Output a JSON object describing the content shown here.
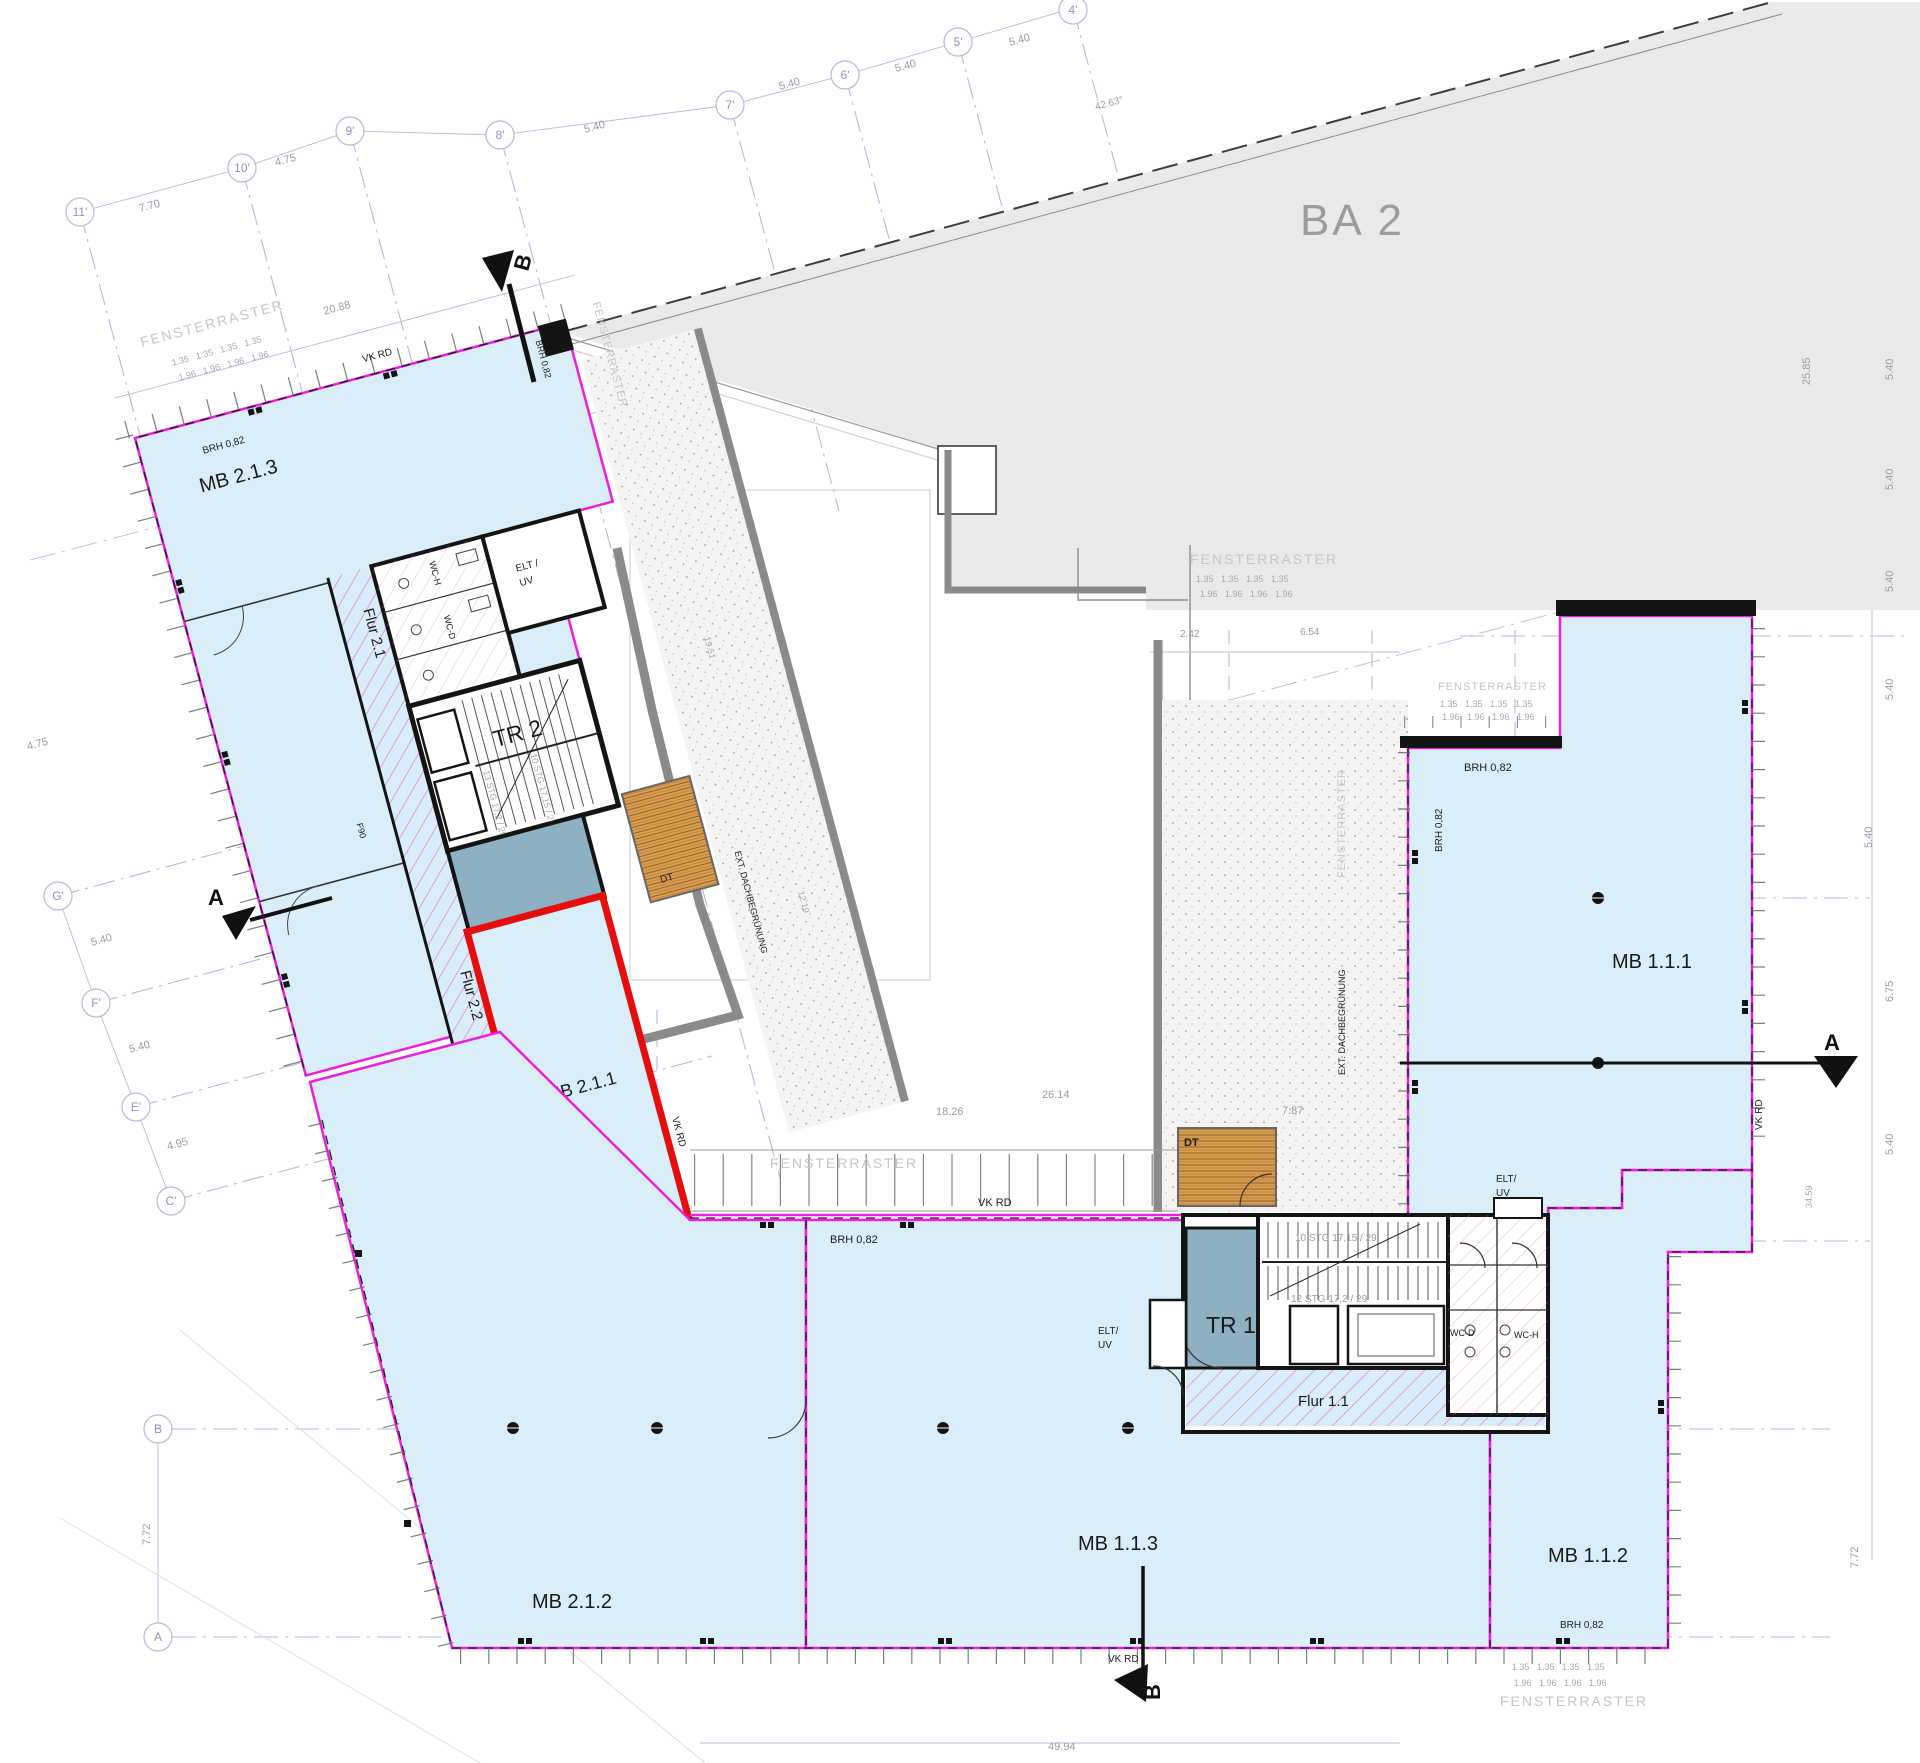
{
  "title": "Floor plan",
  "rooms": {
    "mb213": "MB 2.1.3",
    "mb211": "MB 2.1.1",
    "mb212": "MB 2.1.2",
    "mb111": "MB 1.1.1",
    "mb112": "MB 1.1.2",
    "mb113": "MB 1.1.3",
    "tr1": "TR 1",
    "tr2": "TR 2",
    "flur11": "Flur 1.1",
    "flur21": "Flur 2.1",
    "flur22": "Flur 2.2",
    "ba2": "BA 2",
    "dt": "DT",
    "wcd": "WC-D",
    "wch": "WC-H",
    "f90": "F90",
    "elt": "ELT/",
    "elt_sp": "ELT /",
    "uv": "UV"
  },
  "annotations": {
    "fensterraster": "FENSTERRASTER",
    "extdach": "EXT. DACHBEGRÜNUNG",
    "vkrd": "VK RD",
    "brh": "BRH 0,82",
    "stair10": "10 STG 17,15 / 29",
    "stair12": "12 STG 17,2 / 29",
    "stair13": "13 STG 17,2 / 29"
  },
  "grid": {
    "n11": "11'",
    "n10": "10'",
    "n9": "9'",
    "n8": "8'",
    "n7": "7'",
    "n6": "6'",
    "n5": "5'",
    "n4": "4'",
    "gG": "G'",
    "gF": "F'",
    "gE": "E'",
    "gC": "C'",
    "gB": "B",
    "gA": "A"
  },
  "sections": {
    "a": "A",
    "b": "B"
  },
  "dims": {
    "d770": "7.70",
    "d475": "4.75",
    "d540": "5.40",
    "d495": "4.95",
    "d772": "7.72",
    "d2088": "20.88",
    "d4263": "42.63°",
    "d2585": "25.85",
    "d675": "6.75",
    "d3459": "34.59",
    "d2614": "26.14",
    "d1826": "18.26",
    "d787": "7.87",
    "d242": "2.42",
    "d654": "6.54",
    "d4994": "49.94",
    "d1951": "19.51",
    "d1219": "12.19",
    "d135x4": "1.35   1.35   1.35   1.35",
    "d196x4": "1.96   1.96   1.96   1.96"
  },
  "colors": {
    "room_fill": "#d9eef8",
    "outline_magenta": "#ec1fe0",
    "highlight_red": "#e60d0d",
    "core_fill": "#8db0c2",
    "corridor_hatch": "#e07ad4",
    "wood_deck": "#d99c50",
    "ba2_fill": "#eaeaea",
    "grid_lavender": "#b8b8dc",
    "wall_black": "#141414",
    "dim_gray": "#9b9ba8"
  }
}
